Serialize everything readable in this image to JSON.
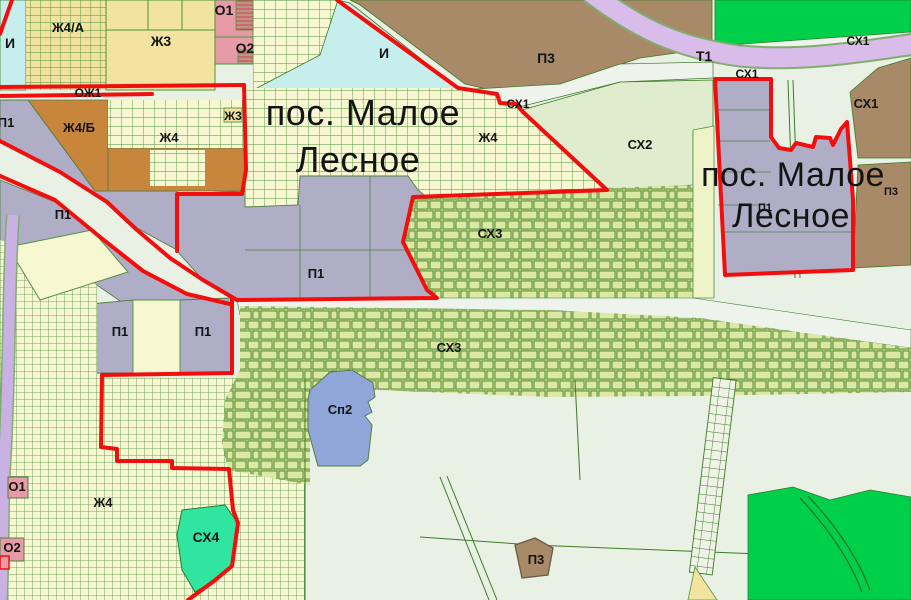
{
  "map": {
    "title": "Zoning map fragment — пос. Малое Лесное",
    "settlement_labels": [
      {
        "text": "пос. Малое",
        "x": 363,
        "y": 125,
        "size": 36
      },
      {
        "text": "Лесное",
        "x": 358,
        "y": 172,
        "size": 36
      },
      {
        "text": "пос. Малое",
        "x": 793,
        "y": 186,
        "size": 34
      },
      {
        "text": "Лесное",
        "x": 791,
        "y": 227,
        "size": 34
      }
    ],
    "zone_labels": [
      {
        "text": "И",
        "x": 10,
        "y": 48,
        "size": 14
      },
      {
        "text": "Ж4/А",
        "x": 68,
        "y": 32,
        "size": 13
      },
      {
        "text": "Ж3",
        "x": 161,
        "y": 46,
        "size": 14
      },
      {
        "text": "О1",
        "x": 224,
        "y": 15,
        "size": 14
      },
      {
        "text": "О2",
        "x": 245,
        "y": 53,
        "size": 14
      },
      {
        "text": "ОЖ1",
        "x": 88,
        "y": 97,
        "size": 12
      },
      {
        "text": "И",
        "x": 384,
        "y": 58,
        "size": 14
      },
      {
        "text": "П3",
        "x": 546,
        "y": 63,
        "size": 14
      },
      {
        "text": "Т1",
        "x": 704,
        "y": 61,
        "size": 14
      },
      {
        "text": "СХ1",
        "x": 858,
        "y": 45,
        "size": 12
      },
      {
        "text": "СХ1",
        "x": 747,
        "y": 78,
        "size": 12
      },
      {
        "text": "СХ1",
        "x": 518,
        "y": 108,
        "size": 12
      },
      {
        "text": "СХ1",
        "x": 866,
        "y": 108,
        "size": 13
      },
      {
        "text": "СХ2",
        "x": 640,
        "y": 149,
        "size": 13
      },
      {
        "text": "Ж4/Б",
        "x": 79,
        "y": 132,
        "size": 13
      },
      {
        "text": "Ж3",
        "x": 233,
        "y": 120,
        "size": 12
      },
      {
        "text": "Ж4",
        "x": 169,
        "y": 142,
        "size": 13
      },
      {
        "text": "Ж4",
        "x": 488,
        "y": 142,
        "size": 13
      },
      {
        "text": "П1",
        "x": 6,
        "y": 127,
        "size": 13
      },
      {
        "text": "П1",
        "x": 63,
        "y": 219,
        "size": 13
      },
      {
        "text": "П1",
        "x": 316,
        "y": 278,
        "size": 13
      },
      {
        "text": "П1",
        "x": 120,
        "y": 336,
        "size": 13
      },
      {
        "text": "П1",
        "x": 203,
        "y": 336,
        "size": 13
      },
      {
        "text": "П1",
        "x": 765,
        "y": 211,
        "size": 11
      },
      {
        "text": "П3",
        "x": 891,
        "y": 195,
        "size": 11
      },
      {
        "text": "СХ3",
        "x": 490,
        "y": 238,
        "size": 13
      },
      {
        "text": "СХ3",
        "x": 449,
        "y": 352,
        "size": 13
      },
      {
        "text": "Сп2",
        "x": 340,
        "y": 414,
        "size": 13
      },
      {
        "text": "О1",
        "x": 17,
        "y": 491,
        "size": 13
      },
      {
        "text": "О2",
        "x": 12,
        "y": 552,
        "size": 13
      },
      {
        "text": "Ж4",
        "x": 103,
        "y": 507,
        "size": 13
      },
      {
        "text": "СХ4",
        "x": 206,
        "y": 542,
        "size": 14
      },
      {
        "text": "П3",
        "x": 536,
        "y": 564,
        "size": 13
      }
    ]
  },
  "colors": {
    "background": "#e9f1e4",
    "parcel_yellow": "#f7f7d2",
    "residential_yellow": "#f2e4a0",
    "engineering_cyan": "#c5eeec",
    "public_pink": "#e79ba6",
    "residential_orange": "#c8853c",
    "industrial_grey": "#afaec6",
    "industrial_brown": "#a88a68",
    "transport_purple": "#d9bce9",
    "road_purple": "#c9b2e3",
    "agro_green_cells": "#dce9a4",
    "agro_pale": "#dfeccd",
    "agro_teal": "#2fe59f",
    "special_blue": "#91a6d8",
    "forest_green": "#00cf4a",
    "boundary_red": "#f30e0e",
    "line_green": "#3c7a28",
    "road_pale": "#eef4ec"
  }
}
